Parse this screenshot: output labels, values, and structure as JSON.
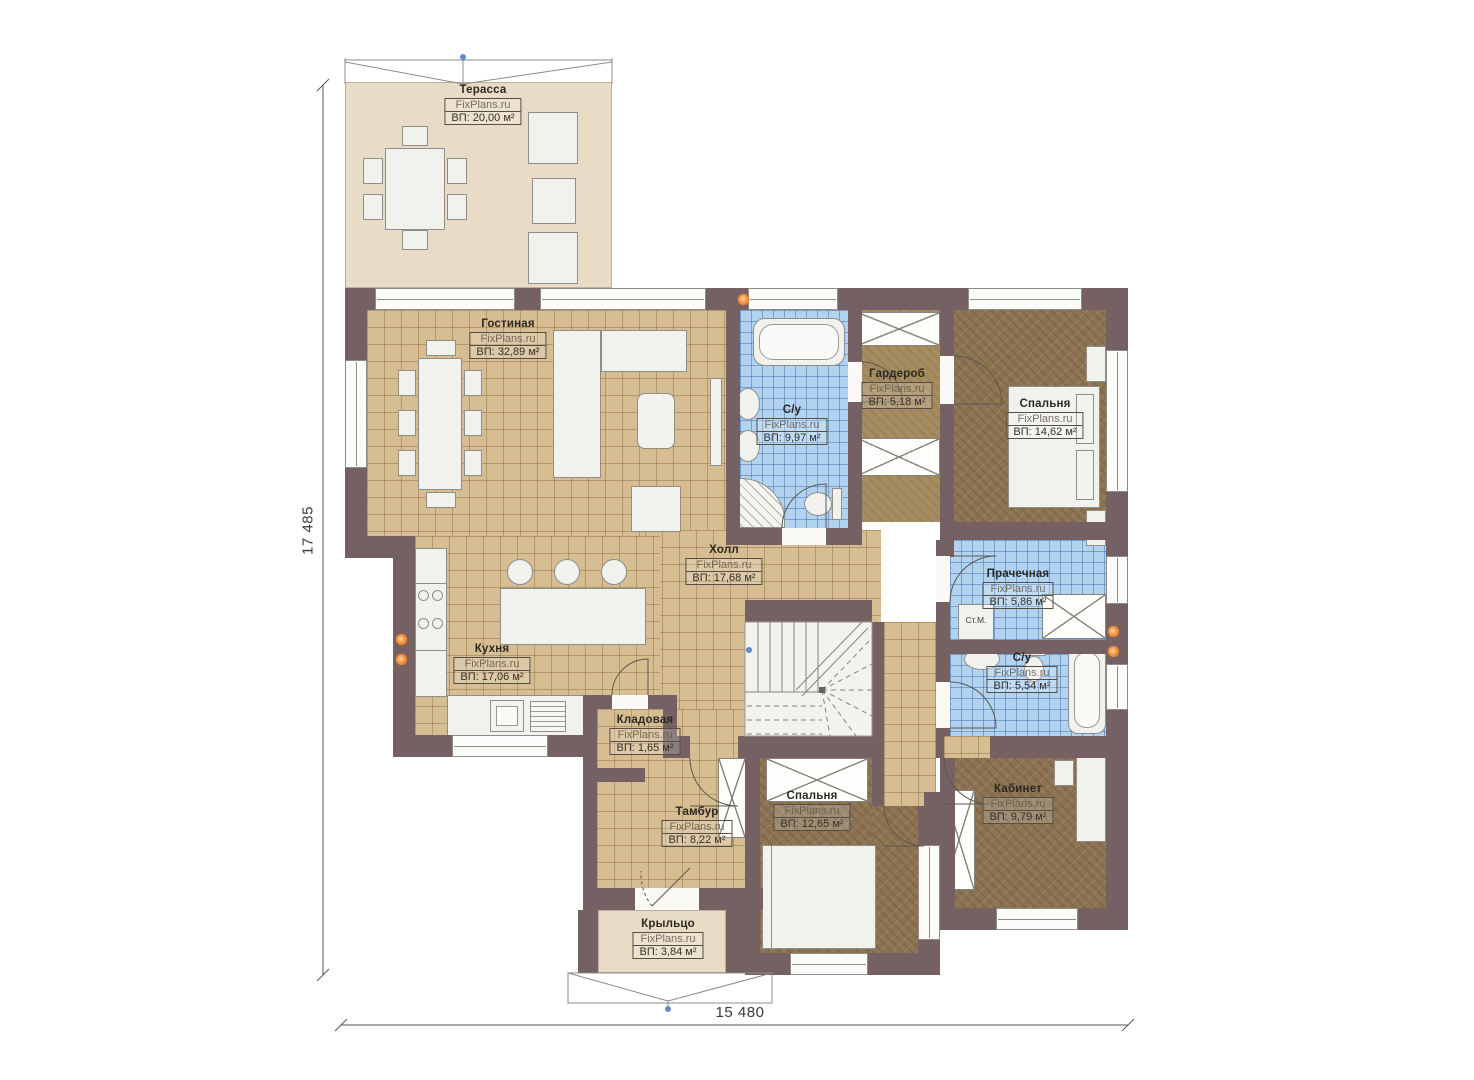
{
  "plan": {
    "watermark": "FixPlans.ru",
    "dimensions": {
      "height": "17 485",
      "width": "15 480"
    },
    "annotations": {
      "washing_machine": "Ст.М."
    },
    "rooms": [
      {
        "id": "terrace",
        "name": "Терасса",
        "watermark": "FixPlans.ru",
        "area": "ВП: 20,00 м²"
      },
      {
        "id": "living-room",
        "name": "Гостиная",
        "watermark": "FixPlans.ru",
        "area": "ВП: 32,89 м²"
      },
      {
        "id": "bathroom-main",
        "name": "С/у",
        "watermark": "FixPlans.ru",
        "area": "ВП: 9,97 м²"
      },
      {
        "id": "wardrobe",
        "name": "Гардероб",
        "watermark": "FixPlans.ru",
        "area": "ВП: 5,18 м²"
      },
      {
        "id": "bedroom-1",
        "name": "Спальня",
        "watermark": "FixPlans.ru",
        "area": "ВП: 14,62 м²"
      },
      {
        "id": "hall",
        "name": "Холл",
        "watermark": "FixPlans.ru",
        "area": "ВП: 17,68 м²"
      },
      {
        "id": "laundry",
        "name": "Прачечная",
        "watermark": "FixPlans.ru",
        "area": "ВП: 5,86 м²"
      },
      {
        "id": "bathroom-2",
        "name": "С/у",
        "watermark": "FixPlans.ru",
        "area": "ВП: 5,54 м²"
      },
      {
        "id": "kitchen",
        "name": "Кухня",
        "watermark": "FixPlans.ru",
        "area": "ВП: 17,06 м²"
      },
      {
        "id": "storage",
        "name": "Кладовая",
        "watermark": "FixPlans.ru",
        "area": "ВП: 1,65 м²"
      },
      {
        "id": "vestibule",
        "name": "Тамбур",
        "watermark": "FixPlans.ru",
        "area": "ВП: 8,22 м²"
      },
      {
        "id": "bedroom-2",
        "name": "Спальня",
        "watermark": "FixPlans.ru",
        "area": "ВП: 12,65 м²"
      },
      {
        "id": "office",
        "name": "Кабинет",
        "watermark": "FixPlans.ru",
        "area": "ВП: 9,79 м²"
      },
      {
        "id": "porch",
        "name": "Крыльцо",
        "watermark": "FixPlans.ru",
        "area": "ВП: 3,84 м²"
      }
    ]
  }
}
